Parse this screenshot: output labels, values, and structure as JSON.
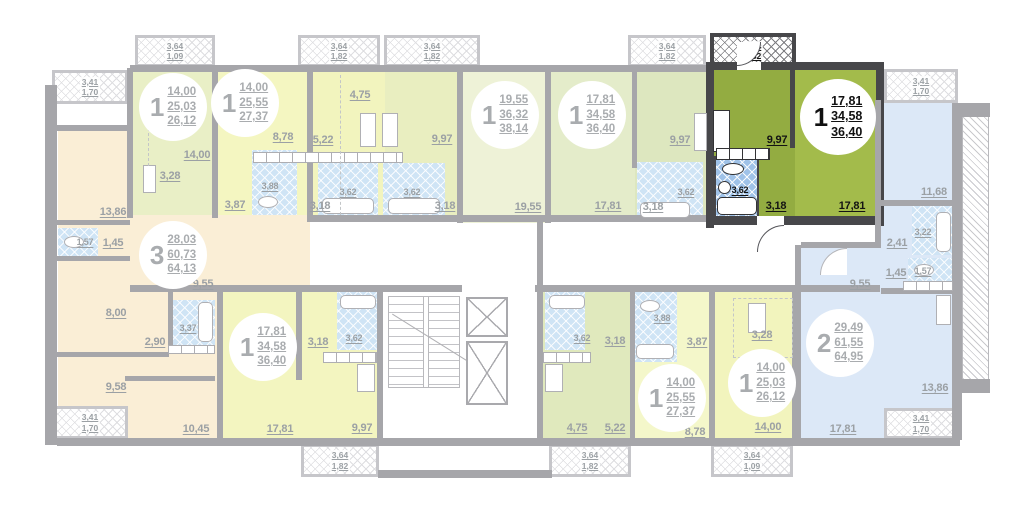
{
  "units": [
    {
      "type": "1",
      "rooms": "14,00",
      "total": "25,03",
      "area": "26,12"
    },
    {
      "type": "1",
      "rooms": "14,00",
      "total": "25,55",
      "area": "27,37"
    },
    {
      "type": "1",
      "rooms": "19,55",
      "total": "36,32",
      "area": "38,14"
    },
    {
      "type": "1",
      "rooms": "17,81",
      "total": "34,58",
      "area": "36,40"
    },
    {
      "type": "1",
      "rooms": "17,81",
      "total": "34,58",
      "area": "36,40"
    },
    {
      "type": "3",
      "rooms": "28,03",
      "total": "60,73",
      "area": "64,13"
    },
    {
      "type": "2",
      "rooms": "29,49",
      "total": "61,55",
      "area": "64,95"
    },
    {
      "type": "1",
      "rooms": "17,81",
      "total": "34,58",
      "area": "36,40"
    },
    {
      "type": "1",
      "rooms": "14,00",
      "total": "25,55",
      "area": "27,37"
    },
    {
      "type": "1",
      "rooms": "14,00",
      "total": "25,03",
      "area": "26,12"
    }
  ],
  "rooms": [
    "13,86",
    "1,57",
    "1,45",
    "9,55",
    "8,00",
    "3,37",
    "2,90",
    "9,58",
    "10,45",
    "14,00",
    "3,28",
    "8,78",
    "3,88",
    "3,87",
    "4,75",
    "5,22",
    "3,62",
    "3,18",
    "9,97",
    "3,62",
    "3,18",
    "19,55",
    "17,81",
    "9,97",
    "3,62",
    "3,18",
    "9,97",
    "3,62",
    "3,18",
    "17,81",
    "11,68",
    "3,22",
    "2,41",
    "1,45",
    "1,57",
    "9,55",
    "13,86",
    "17,81",
    "3,18",
    "3,62",
    "17,81",
    "9,97",
    "3,62",
    "3,18",
    "4,75",
    "5,22",
    "3,88",
    "3,87",
    "3,28",
    "8,78",
    "14,00"
  ],
  "balconies": [
    {
      "a": "3,64",
      "b": "1,09"
    },
    {
      "a": "3,64",
      "b": "1,82"
    },
    {
      "a": "3,64",
      "b": "1,82"
    },
    {
      "a": "3,64",
      "b": "1,82"
    },
    {
      "a": "3,64",
      "b": "1,82"
    },
    {
      "a": "3,41",
      "b": "1,70"
    },
    {
      "a": "3,41",
      "b": "1,70"
    },
    {
      "a": "3,41",
      "b": "1,70"
    },
    {
      "a": "3,41",
      "b": "1,70"
    },
    {
      "a": "3,64",
      "b": "1,82"
    },
    {
      "a": "3,64",
      "b": "1,82"
    },
    {
      "a": "3,64",
      "b": "1,09"
    }
  ],
  "colors": {
    "highlight_kitchen": "#93ac41",
    "highlight_room": "#a3bb4b",
    "highlight_wall": "#47474a",
    "orange": "#faeed6",
    "yellow": "#f4f6c1",
    "green_pale": "#eef2d7",
    "blue": "#dce8f7",
    "bath_blue": "#cfe4f5",
    "wall_gray": "#a6a6aa"
  }
}
